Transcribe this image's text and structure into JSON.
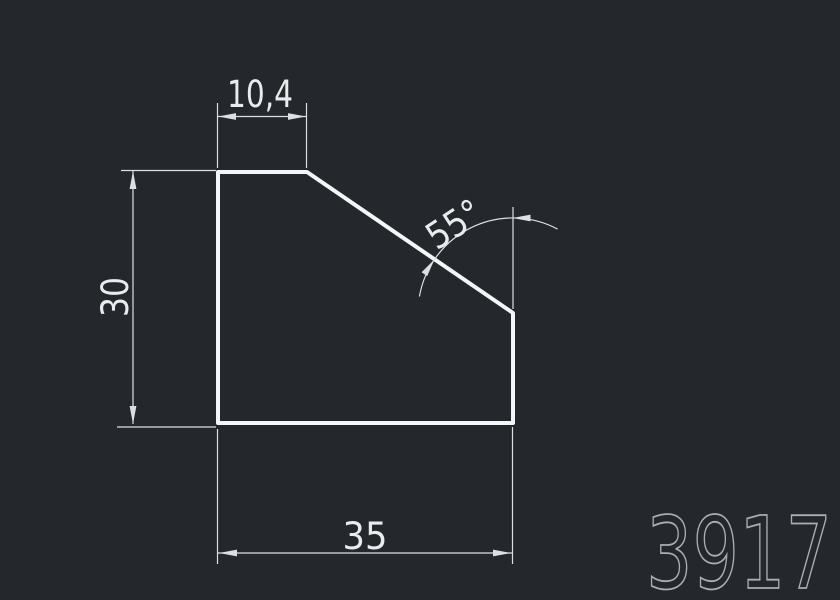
{
  "drawing": {
    "profile_number": "3917",
    "dimensions": {
      "top_width": "10,4",
      "height": "30",
      "bottom_width": "35",
      "chamfer_angle": "55°"
    },
    "colors": {
      "background": "#24272c",
      "outline": "#f4f6f7",
      "dimension_lines": "#dde0e3",
      "dimension_text": "#e9ebed",
      "profile_number_color": "#a9aeb4"
    }
  }
}
